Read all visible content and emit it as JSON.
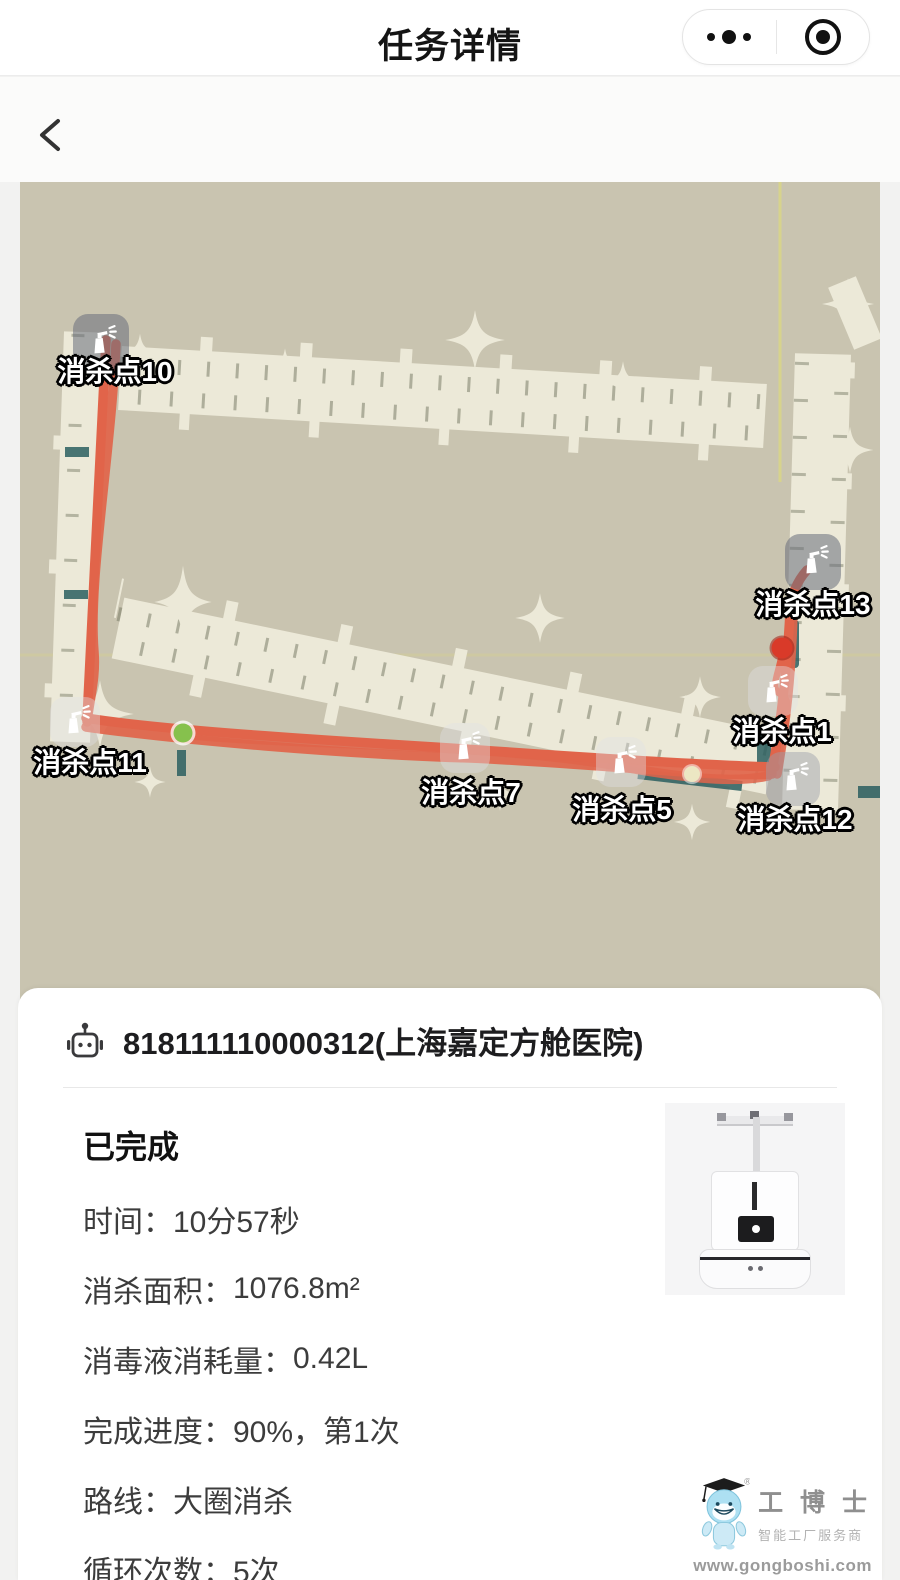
{
  "nav": {
    "title": "任务详情"
  },
  "map": {
    "points": [
      {
        "label": "消杀点10",
        "icon_x": 81,
        "icon_y": 160,
        "label_x": 95,
        "label_y": 188,
        "tone": "dark"
      },
      {
        "label": "消杀点13",
        "icon_x": 793,
        "icon_y": 380,
        "label_x": 793,
        "label_y": 421,
        "tone": "dark"
      },
      {
        "label": "消杀点1",
        "icon_x": 753,
        "icon_y": 509,
        "label_x": 762,
        "label_y": 548,
        "tone": "light"
      },
      {
        "label": "消杀点11",
        "icon_x": 55,
        "icon_y": 540,
        "label_x": 70,
        "label_y": 579,
        "tone": "light"
      },
      {
        "label": "消杀点7",
        "icon_x": 445,
        "icon_y": 566,
        "label_x": 451,
        "label_y": 609,
        "tone": "light"
      },
      {
        "label": "消杀点5",
        "icon_x": 601,
        "icon_y": 580,
        "label_x": 602,
        "label_y": 626,
        "tone": "light"
      },
      {
        "label": "消杀点12",
        "icon_x": 773,
        "icon_y": 597,
        "label_x": 775,
        "label_y": 636,
        "tone": "mid"
      }
    ],
    "markers": [
      {
        "name": "robot-position-dot",
        "color": "#d93a29",
        "x": 762,
        "y": 466,
        "size": 21
      },
      {
        "name": "waypoint-dot-green",
        "color": "#86c14d",
        "x": 163,
        "y": 551,
        "size": 19
      },
      {
        "name": "waypoint-dot-pale",
        "color": "#ece7c3",
        "x": 672,
        "y": 592,
        "size": 16
      }
    ],
    "colors": {
      "background": "#c9c4b0",
      "floor": "#ece9d8",
      "route": "#e1644a",
      "teal_accent": "#2b5f60",
      "grid_yellow": "#d9d589"
    }
  },
  "device": {
    "title": "818111110000312(上海嘉定方舱医院)"
  },
  "task": {
    "status": "已完成",
    "rows": [
      {
        "label": "时间：",
        "value": "10分57秒"
      },
      {
        "label": "消杀面积：",
        "value": "1076.8m²"
      },
      {
        "label": "消毒液消耗量：",
        "value": "0.42L"
      },
      {
        "label": "完成进度：",
        "value": "90%，第1次"
      },
      {
        "label": "路线：",
        "value": "大圈消杀"
      },
      {
        "label": "循环次数：",
        "value": "5次"
      }
    ]
  },
  "watermark": {
    "brand": "工 博 士",
    "slogan": "智能工厂服务商",
    "url": "www.gongboshi.com"
  }
}
